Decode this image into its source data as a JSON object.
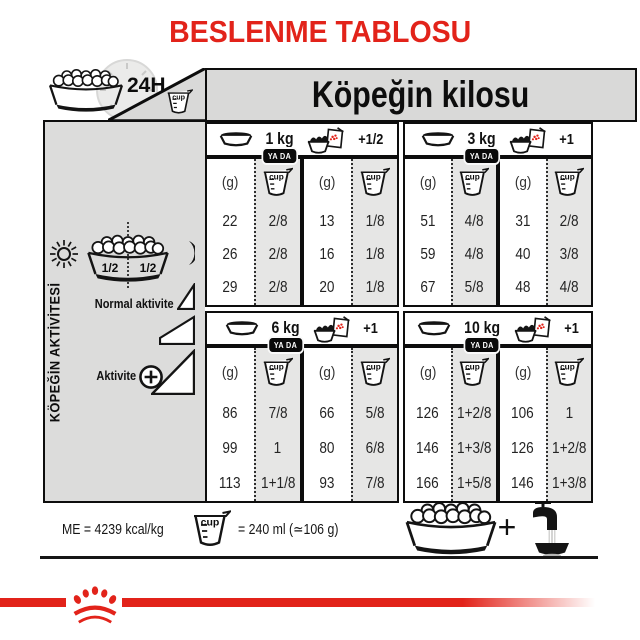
{
  "title": "BESLENME TABLOSU",
  "top": {
    "daily_label": "24H",
    "weight_title": "Köpeğin kilosu"
  },
  "sidebar": {
    "vertical_title": "KÖPEĞİN AKTİVİTESİ",
    "half_left": "1/2",
    "half_right": "1/2",
    "normal_activity_label": "Normal aktivite",
    "activity_label": "Aktivite"
  },
  "table": {
    "or_label": "YA DA",
    "gram_header": "(g)",
    "cup_icon_label": "cup",
    "blocks": [
      {
        "weight": "1 kg",
        "extra": "+1/2",
        "dry_g": [
          "22",
          "26",
          "29"
        ],
        "dry_cup": [
          "2/8",
          "2/8",
          "2/8"
        ],
        "mix_g": [
          "13",
          "16",
          "20"
        ],
        "mix_cup": [
          "1/8",
          "1/8",
          "1/8"
        ]
      },
      {
        "weight": "3 kg",
        "extra": "+1",
        "dry_g": [
          "51",
          "59",
          "67"
        ],
        "dry_cup": [
          "4/8",
          "4/8",
          "5/8"
        ],
        "mix_g": [
          "31",
          "40",
          "48"
        ],
        "mix_cup": [
          "2/8",
          "3/8",
          "4/8"
        ]
      },
      {
        "weight": "6 kg",
        "extra": "+1",
        "dry_g": [
          "86",
          "99",
          "113"
        ],
        "dry_cup": [
          "7/8",
          "1",
          "1+1/8"
        ],
        "mix_g": [
          "66",
          "80",
          "93"
        ],
        "mix_cup": [
          "5/8",
          "6/8",
          "7/8"
        ]
      },
      {
        "weight": "10 kg",
        "extra": "+1",
        "dry_g": [
          "126",
          "146",
          "166"
        ],
        "dry_cup": [
          "1+2/8",
          "1+3/8",
          "1+5/8"
        ],
        "mix_g": [
          "106",
          "126",
          "146"
        ],
        "mix_cup": [
          "1",
          "1+2/8",
          "1+3/8"
        ]
      }
    ]
  },
  "footer": {
    "me_label": "ME = 4239 kcal/kg",
    "cup_equivalence": "= 240 ml (≃106 g)",
    "plus": "+"
  },
  "colors": {
    "brand_red": "#e2231a",
    "panel_gray": "#dcdcdb",
    "band_gray": "#d9d9d8",
    "cup_column_gray": "#e6e6e5"
  }
}
